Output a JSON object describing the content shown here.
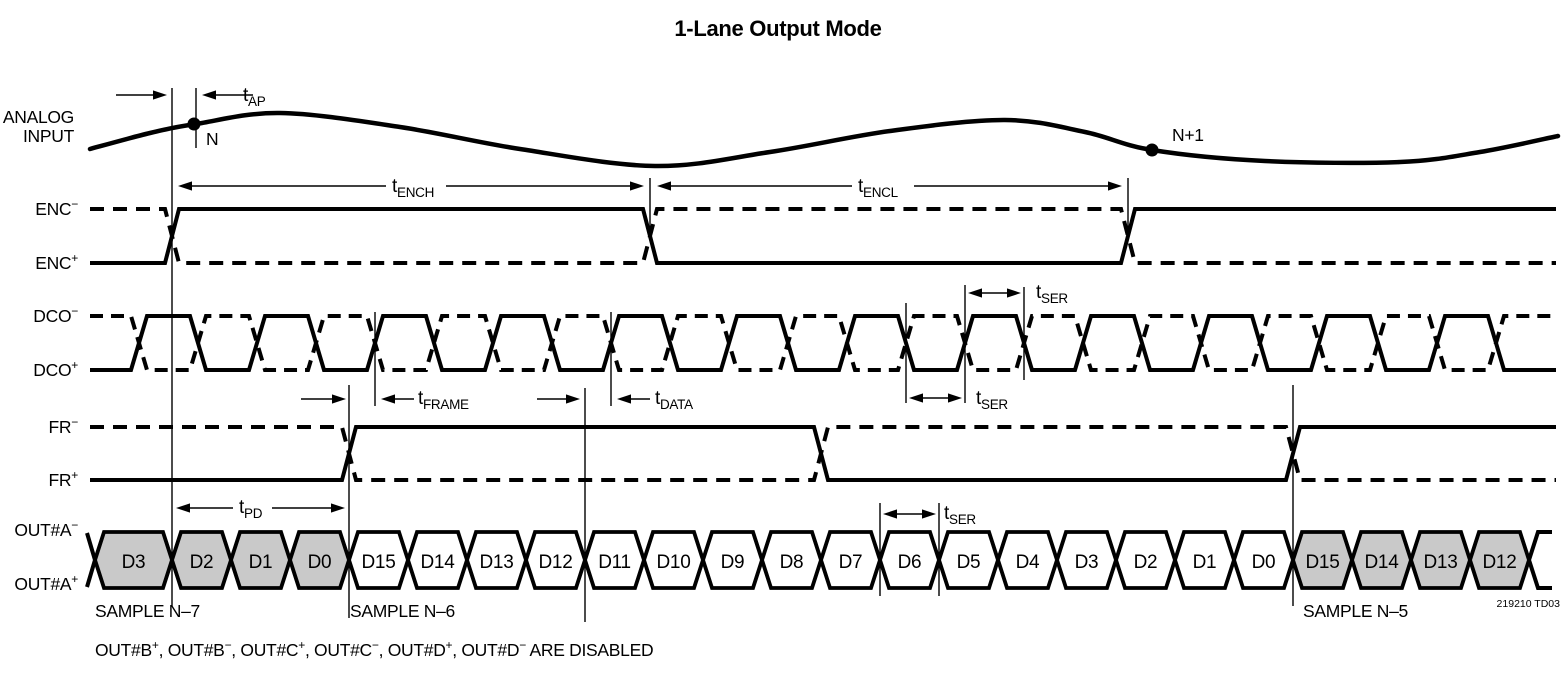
{
  "title": "1-Lane Output Mode",
  "signals": {
    "analog": {
      "line1": "ANALOG",
      "line2": "INPUT"
    },
    "enc_n": {
      "base": "ENC",
      "sup": "−"
    },
    "enc_p": {
      "base": "ENC",
      "sup": "+"
    },
    "dco_n": {
      "base": "DCO",
      "sup": "−"
    },
    "dco_p": {
      "base": "DCO",
      "sup": "+"
    },
    "fr_n": {
      "base": "FR",
      "sup": "−"
    },
    "fr_p": {
      "base": "FR",
      "sup": "+"
    },
    "outa_n": {
      "base": "OUT#A",
      "sup": "−"
    },
    "outa_p": {
      "base": "OUT#A",
      "sup": "+"
    }
  },
  "timing_labels": {
    "tap": {
      "base": "t",
      "sub": "AP"
    },
    "tench": {
      "base": "t",
      "sub": "ENCH"
    },
    "tencl": {
      "base": "t",
      "sub": "ENCL"
    },
    "tframe": {
      "base": "t",
      "sub": "FRAME"
    },
    "tdata": {
      "base": "t",
      "sub": "DATA"
    },
    "tser_top": {
      "base": "t",
      "sub": "SER"
    },
    "tser_mid": {
      "base": "t",
      "sub": "SER"
    },
    "tser_bus": {
      "base": "t",
      "sub": "SER"
    },
    "tpd": {
      "base": "t",
      "sub": "PD"
    }
  },
  "samples": {
    "n": "N",
    "n_plus_1": "N+1",
    "n7": "SAMPLE N–7",
    "n6": "SAMPLE N–6",
    "n5": "SAMPLE N–5"
  },
  "bus": {
    "cells": [
      {
        "label": "D3",
        "shaded": true
      },
      {
        "label": "D2",
        "shaded": true
      },
      {
        "label": "D1",
        "shaded": true
      },
      {
        "label": "D0",
        "shaded": true
      },
      {
        "label": "D15",
        "shaded": false
      },
      {
        "label": "D14",
        "shaded": false
      },
      {
        "label": "D13",
        "shaded": false
      },
      {
        "label": "D12",
        "shaded": false
      },
      {
        "label": "D11",
        "shaded": false
      },
      {
        "label": "D10",
        "shaded": false
      },
      {
        "label": "D9",
        "shaded": false
      },
      {
        "label": "D8",
        "shaded": false
      },
      {
        "label": "D7",
        "shaded": false
      },
      {
        "label": "D6",
        "shaded": false
      },
      {
        "label": "D5",
        "shaded": false
      },
      {
        "label": "D4",
        "shaded": false
      },
      {
        "label": "D3",
        "shaded": false
      },
      {
        "label": "D2",
        "shaded": false
      },
      {
        "label": "D1",
        "shaded": false
      },
      {
        "label": "D0",
        "shaded": false
      },
      {
        "label": "D15",
        "shaded": true
      },
      {
        "label": "D14",
        "shaded": true
      },
      {
        "label": "D13",
        "shaded": true
      },
      {
        "label": "D12",
        "shaded": true
      }
    ]
  },
  "footer": {
    "segments": [
      {
        "t": "OUT#B",
        "sup": "+"
      },
      {
        "t": ", OUT#B",
        "sup": "−"
      },
      {
        "t": ", OUT#C",
        "sup": "+"
      },
      {
        "t": ", OUT#C",
        "sup": "−"
      },
      {
        "t": ", OUT#D",
        "sup": "+"
      },
      {
        "t": ", OUT#D",
        "sup": "−"
      },
      {
        "t": " ARE DISABLED"
      }
    ]
  },
  "part_note": "219210 TD03",
  "colors": {
    "ink": "#000000",
    "shade": "#c9c9c9",
    "background": "#ffffff"
  }
}
